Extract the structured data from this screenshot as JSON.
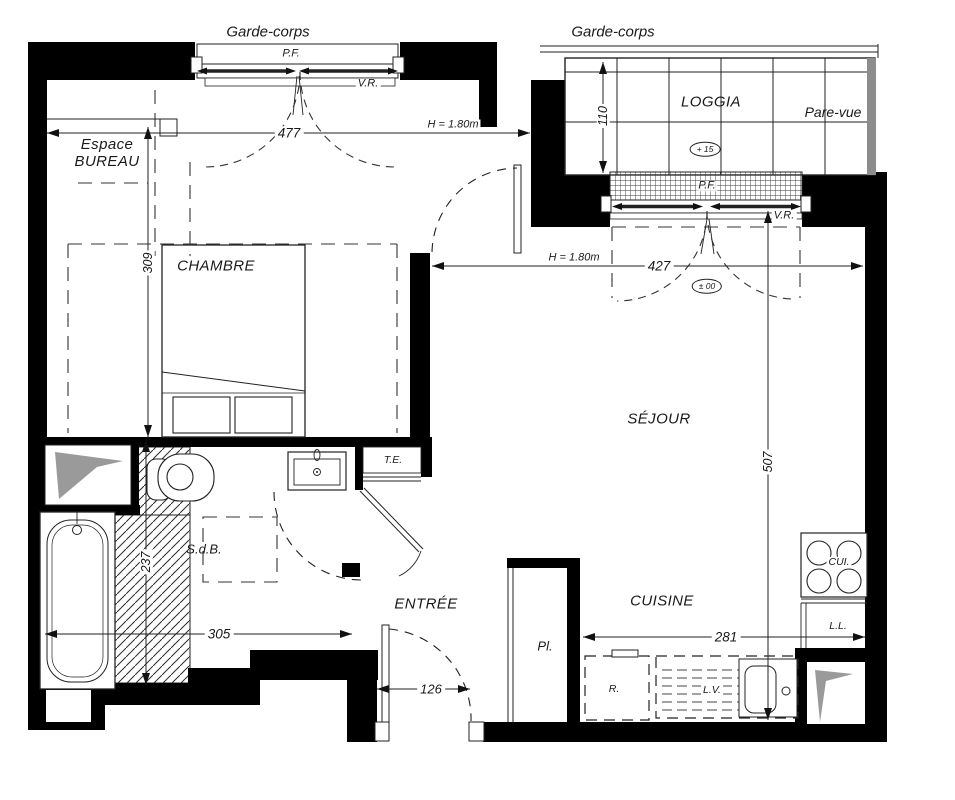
{
  "plan": {
    "balcony_labels": {
      "garde_corps_left": "Garde-corps",
      "garde_corps_right": "Garde-corps",
      "loggia": "LOGGIA",
      "pare_vue": "Pare-vue"
    },
    "rooms": {
      "espace_bureau_line1": "Espace",
      "espace_bureau_line2": "BUREAU",
      "chambre": "CHAMBRE",
      "sejour": "SÉJOUR",
      "sdb": "S.d.B.",
      "entree": "ENTRÉE",
      "cuisine": "CUISINE"
    },
    "windows": {
      "pf_chambre": "P.F.",
      "vr_chambre": "V.R.",
      "pf_sejour": "P.F.",
      "vr_sejour": "V.R."
    },
    "fixtures": {
      "te": "T.E.",
      "pl": "Pl.",
      "cui": "CUI.",
      "ll": "L.L.",
      "refrigerator": "R.",
      "lv": "L.V."
    },
    "dimensions": {
      "chambre_width": "477",
      "chambre_depth": "309",
      "loggia_depth": "110",
      "sejour_width": "427",
      "sejour_depth": "507",
      "sdb_depth": "237",
      "sdb_width": "305",
      "entree_door": "126",
      "cuisine_width": "281",
      "height_note_chambre": "H = 1.80m",
      "height_note_sejour": "H = 1.80m"
    },
    "levels": {
      "loggia": "+ 15",
      "sejour": "± 00"
    },
    "colors": {
      "wall": "#000000",
      "duct_gray": "#9a9a9a",
      "parevue_gray": "#8c8c8c",
      "line": "#222222"
    }
  }
}
